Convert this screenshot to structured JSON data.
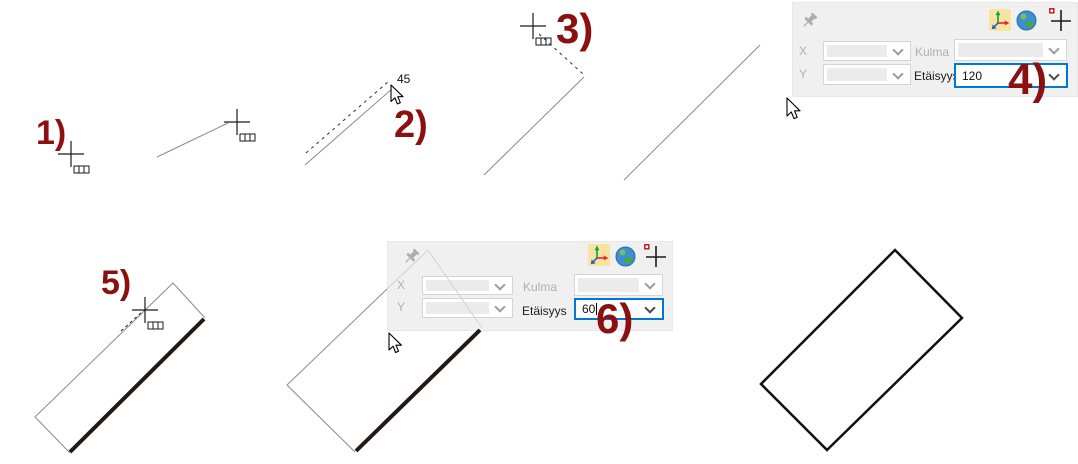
{
  "step_labels": [
    "1)",
    "2)",
    "3)",
    "4)",
    "5)",
    "6)"
  ],
  "angle_annotation": "45",
  "panel_top": {
    "x_label": "X",
    "y_label": "Y",
    "angle_label": "Kulma",
    "distance_label": "Etäisyys",
    "distance_value": "120",
    "icons": [
      "pin-icon",
      "axis-origin-icon",
      "globe-icon",
      "crosshair-plus-icon"
    ]
  },
  "panel_middle": {
    "x_label": "X",
    "y_label": "Y",
    "angle_label": "Kulma",
    "distance_label": "Etäisyys",
    "distance_value": "60",
    "icons": [
      "pin-icon",
      "axis-origin-icon",
      "globe-icon",
      "crosshair-plus-icon"
    ]
  },
  "colors": {
    "step_label": "#8b1111",
    "focus_border": "#0078d7",
    "panel_bg": "#f0f0f0",
    "thin_line": "#8a8a8a",
    "dashed_line": "#303030",
    "thick_line": "#241812",
    "final_outline": "#101010",
    "axis_icon_bg": "#f8e49e"
  }
}
